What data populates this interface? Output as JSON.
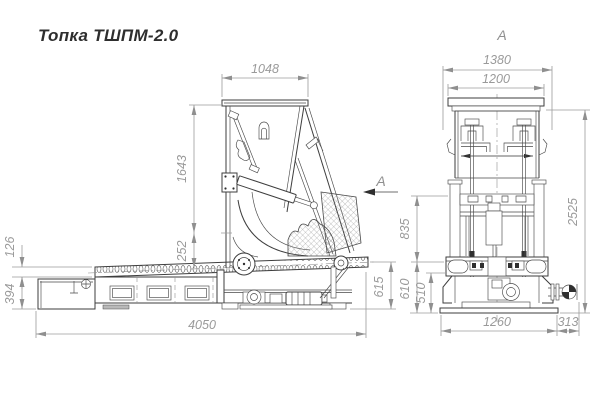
{
  "title": "Топка ТШПМ-2.0",
  "colors": {
    "line": "#3e3e3e",
    "dimension": "#9b9b9b",
    "background": "#ffffff"
  },
  "side_view": {
    "section_label": "А",
    "dims": {
      "hopper_top_width": "1048",
      "hopper_height": "1643",
      "chute_offset": "252",
      "chain_height": "126",
      "frame_height": "394",
      "overall_length": "4050",
      "discharge_height": "615"
    }
  },
  "front_view": {
    "view_label": "А",
    "dims": {
      "overall_width": "1380",
      "lid_width": "1200",
      "overall_height": "2525",
      "mid_height": "835",
      "base_height_outer": "610",
      "base_height_inner": "510",
      "base_width": "1260",
      "shaft_extension": "313"
    }
  }
}
